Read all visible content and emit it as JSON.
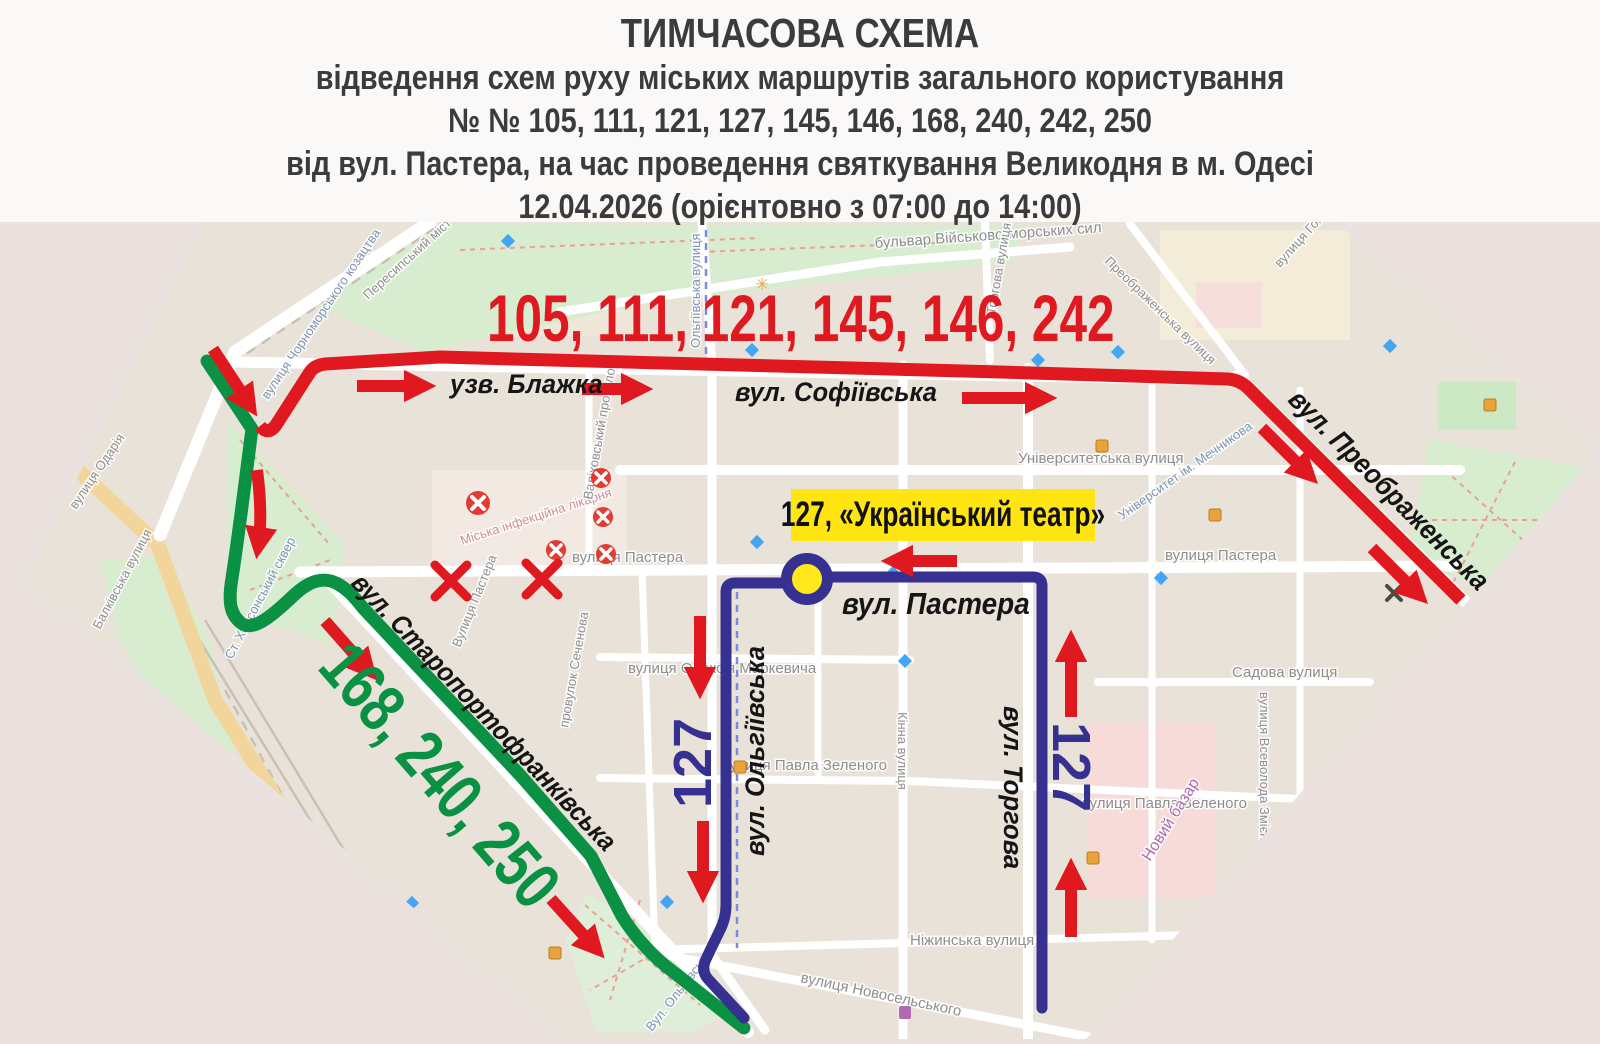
{
  "colors": {
    "red": "#e0181f",
    "green": "#0a9144",
    "navy": "#363090",
    "badge_bg": "#ffe512",
    "stop_yellow": "#ffe91c"
  },
  "header": {
    "lines": [
      "ТИМЧАСОВА СХЕМА",
      "відведення схем руху міських маршрутів загального користування",
      "№ № 105, 111, 121, 127, 145, 146, 168, 240, 242, 250",
      "від вул. Пастера, на час проведення святкування Великодня в м. Одесі",
      "12.04.2026 (орієнтовно з 07:00 до 14:00)"
    ]
  },
  "overlay": {
    "red_routes": "105, 111, 121, 145, 146, 242",
    "green_routes": "168, 240, 250",
    "navy_route_left": "127",
    "navy_route_right": "127",
    "badge": "127, «Український театр»",
    "streets": {
      "blazhka": "узв. Блажка",
      "sofiivska": "вул. Софіївська",
      "preobrazhenska": "вул. Преображенська",
      "staroportofrankivska": "вул. Старопортофранківська",
      "pastera": "вул. Пастера",
      "olhiivska": "вул. Ольгіївська",
      "torhova": "вул. Торгова"
    }
  },
  "map_labels": {
    "boulevard": "бульвар Військово-морських сил",
    "peresypskyi": "Пересипський міст",
    "chornomorskoho": "вулиця Чорноморського козацтва",
    "odariia": "вулиця Одарія",
    "balkivska": "Балківська вулиця",
    "khersonskyi": "Ст. Херсонський сквер",
    "likarnia": "Міська інфекційна лікарня",
    "valikhovskyi": "Валіховський провулок",
    "sechenova": "провулок Сеченова",
    "pastera_w": "вулиця Пастера",
    "pastera_s": "Вулиця Пастера",
    "pastera_e": "вулиця Пастера",
    "olhiivska_n": "Ольгіївська вулиця",
    "olhiivska_s": "Вул. Ольгіївська",
    "torhova_n": "Торгова вулиця",
    "universytetska": "Університетська вулиця",
    "universytet": "Університет ім. Мечникова",
    "markevycha": "вулиця Олексія Маркевича",
    "sadova": "Садова вулиця",
    "zmiienka": "вулиця Всеволода Змієнка",
    "zelenoho_w": "вулиця Павла Зеленого",
    "zelenoho_e": "вулиця Павла Зеленого",
    "kinna": "Кінна вулиця",
    "novyi_bazar": "Новий базар",
    "nizhynska": "Ніжинська вулиця",
    "novoselskoho": "вулиця Новосельського",
    "preobrazhenska_n": "Преображенська вулиця",
    "hoholia": "вулиця Гоголя"
  }
}
